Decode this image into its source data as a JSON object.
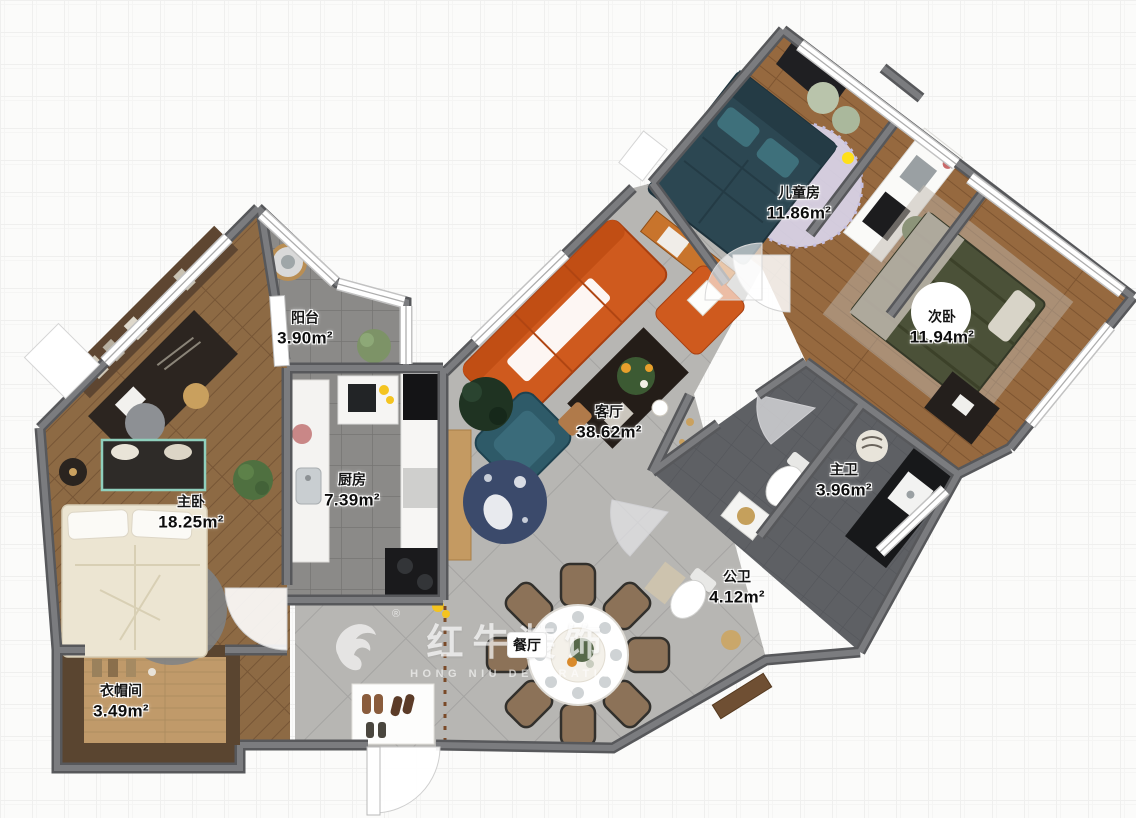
{
  "app": {
    "title": "户型彩平图",
    "type": "floor-plan-render"
  },
  "rooms": [
    {
      "id": "children-room",
      "name": "儿童房",
      "area": "11.86m²"
    },
    {
      "id": "second-bedroom",
      "name": "次卧",
      "area": "11.94m²"
    },
    {
      "id": "balcony",
      "name": "阳台",
      "area": "3.90m²"
    },
    {
      "id": "master-bedroom",
      "name": "主卧",
      "area": "18.25m²"
    },
    {
      "id": "kitchen",
      "name": "厨房",
      "area": "7.39m²"
    },
    {
      "id": "living-room",
      "name": "客厅",
      "area": "38.62m²"
    },
    {
      "id": "master-bathroom",
      "name": "主卫",
      "area": "3.96m²"
    },
    {
      "id": "public-bathroom",
      "name": "公卫",
      "area": "4.12m²"
    },
    {
      "id": "dining-room",
      "name": "餐厅",
      "area": ""
    },
    {
      "id": "cloakroom",
      "name": "衣帽间",
      "area": "3.49m²"
    }
  ],
  "watermark": {
    "title": "红牛装饰",
    "subtitle": "HONG NIU DECORATION",
    "registered": "®"
  },
  "palette": {
    "woodMid": "#96693f",
    "woodMaster": "#8d6a44",
    "woodCorridor": "#7c5636",
    "tileLight": "#b7b6b3",
    "tileMid": "#8b8a88",
    "tileDark": "#5e6064",
    "wall": "#7b7c7f",
    "wallEdge": "#57585b",
    "sofaOrange": "#cf5a1e",
    "bedTeal": "#2c4752",
    "bedOlive": "#4b5138",
    "bedCream": "#ece5d2",
    "rugLavender": "#d9d5ea",
    "chairBrown": "#8c7258"
  }
}
